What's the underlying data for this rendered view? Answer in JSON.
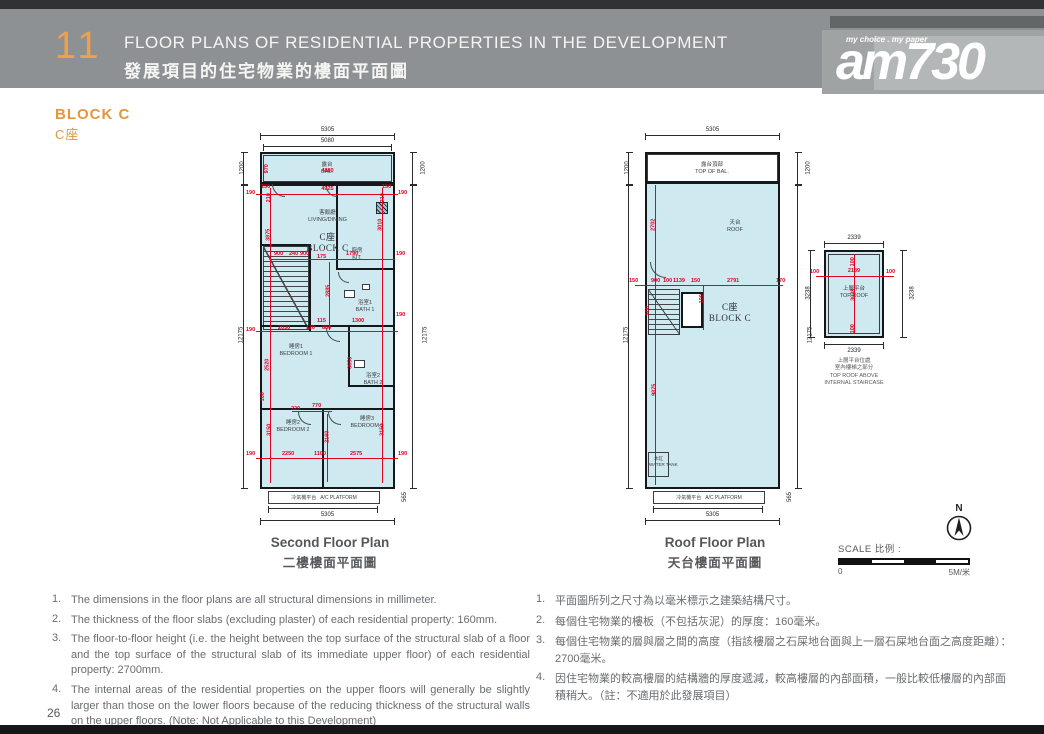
{
  "header": {
    "section_number": "11",
    "title_en": "FLOOR PLANS OF RESIDENTIAL PROPERTIES IN THE DEVELOPMENT",
    "title_zh": "發展項目的住宅物業的樓面平面圖"
  },
  "logo": {
    "tagline": "my choice . my paper",
    "name": "am730"
  },
  "block": {
    "name_en": "BLOCK C",
    "name_zh": "C座"
  },
  "colors": {
    "accent_orange": "#e2973f",
    "dim_red": "#e30021",
    "plan_fill": "#cfe9f1",
    "header_gray": "#8e9193"
  },
  "second_floor": {
    "caption_en": "Second Floor Plan",
    "caption_zh": "二樓樓面平面圖",
    "unit_zh": "C座",
    "unit_en": "BLOCK C",
    "rooms": {
      "balcony": {
        "zh": "露台",
        "en": "BAL."
      },
      "living": {
        "zh": "客飯廳",
        "en": "LIVING/DINING"
      },
      "kitchen": {
        "zh": "廚房",
        "en": "KIT."
      },
      "bath1": {
        "zh": "浴室1",
        "en": "BATH 1"
      },
      "bath2": {
        "zh": "浴室2",
        "en": "BATH 2"
      },
      "bedroom1": {
        "zh": "睡房1",
        "en": "BEDROOM 1"
      },
      "bedroom2": {
        "zh": "睡房2",
        "en": "BEDROOM 2"
      },
      "bedroom3": {
        "zh": "睡房3",
        "en": "BEDROOM 3"
      },
      "ac": {
        "zh": "冷氣機平台",
        "en": "A/C PLATFORM"
      }
    },
    "dims": {
      "top_outer": "5305",
      "top_inner": "5080",
      "left_upper": "1200",
      "left_main": "12175",
      "right_upper": "1200",
      "right_main": "12175",
      "bottom_inner": "4450",
      "bottom_outer": "5305",
      "bottom_right": "565"
    },
    "red_dims": [
      "150",
      "970",
      "4880",
      "150",
      "210",
      "4925",
      "210",
      "190",
      "190",
      "3010",
      "3875",
      "900",
      "240",
      "900",
      "175",
      "1790",
      "190",
      "2885",
      "115",
      "1300",
      "190",
      "190",
      "2030",
      "110",
      "880",
      "2520",
      "3650",
      "100",
      "220",
      "770",
      "3150",
      "3150",
      "2160",
      "2250",
      "1100",
      "2575",
      "190",
      "190"
    ]
  },
  "roof_floor": {
    "caption_en": "Roof Floor Plan",
    "caption_zh": "天台樓面平面圖",
    "unit_zh": "C座",
    "unit_en": "BLOCK C",
    "rooms": {
      "top_of_bal": {
        "zh": "露台頂部",
        "en": "TOP OF BAL."
      },
      "roof": {
        "zh": "天台",
        "en": "ROOF"
      },
      "water_tank": {
        "zh": "水缸",
        "en": "WATER TANK"
      },
      "ac": {
        "zh": "冷氣機平台",
        "en": "A/C PLATFORM"
      }
    },
    "dims": {
      "top_outer": "5305",
      "left_upper": "1200",
      "left_main": "12175",
      "right_upper": "1200",
      "right_main": "12175",
      "bottom_inner": "4450",
      "bottom_outer": "5305",
      "bottom_right": "565"
    },
    "red_dims": [
      "2702",
      "150",
      "900",
      "100",
      "1139",
      "150",
      "2791",
      "170",
      "100",
      "900",
      "9875"
    ]
  },
  "top_roof": {
    "label": {
      "zh": "上層平台",
      "en": "TOP ROOF"
    },
    "caption": {
      "zh1": "上層平台位處",
      "zh2": "室內樓梯之部分",
      "en1": "TOP ROOF ABOVE",
      "en2": "INTERNAL STAIRCASE"
    },
    "dims": {
      "top": "2339",
      "bottom": "2339",
      "left": "3238",
      "right": "3238"
    },
    "red_dims": {
      "off_left": "100",
      "width": "2139",
      "off_right": "100",
      "off_top": "100",
      "height": "3038",
      "off_bottom": "100"
    }
  },
  "compass": {
    "n": "N"
  },
  "scale": {
    "label_en": "SCALE",
    "label_zh": "比例 :",
    "zero": "0",
    "max": "5M/米"
  },
  "notes_en": {
    "items": [
      "The dimensions in the floor plans are all structural dimensions in millimeter.",
      "The thickness of the floor slabs (excluding plaster) of each residential property: 160mm.",
      "The floor-to-floor height (i.e. the height between the top surface of the structural slab of a floor and the top surface of the structural slab of its immediate upper floor) of each residential property: 2700mm.",
      "The internal areas of the residential properties on the upper floors will generally be slightly larger than those on the lower floors because of the reducing thickness of the structural walls on the upper floors. (Note: Not Applicable to this Development)"
    ],
    "numbers": [
      "1.",
      "2.",
      "3.",
      "4."
    ]
  },
  "notes_zh": {
    "items": [
      "平面圖所列之尺寸為以毫米標示之建築結構尺寸。",
      "每個住宅物業的樓板（不包括灰泥）的厚度：160毫米。",
      "每個住宅物業的層與層之間的高度（指該樓層之石屎地台面與上一層石屎地台面之高度距離）：2700毫米。",
      "因住宅物業的較高樓層的結構牆的厚度遞減，較高樓層的內部面積，一般比較低樓層的內部面積稍大。（註：不適用於此發展項目）"
    ],
    "numbers": [
      "1.",
      "2.",
      "3.",
      "4."
    ]
  },
  "page": {
    "number": "26"
  }
}
